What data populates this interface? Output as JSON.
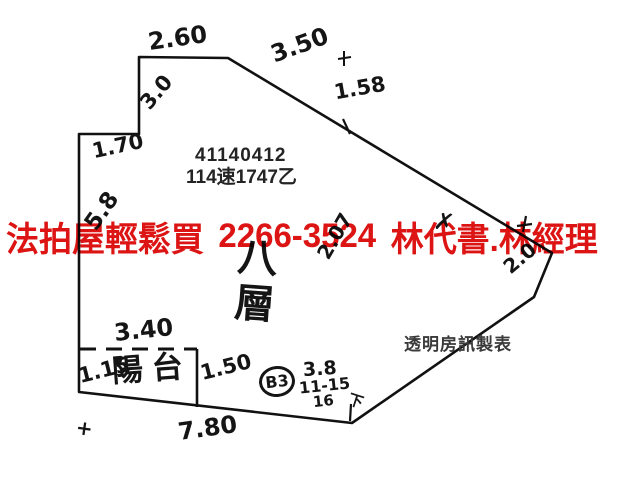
{
  "document": {
    "type_note": "hand-drawn foreclosure floor plan scan",
    "background_color": "#ffffff",
    "ink_color": "#151515"
  },
  "overlay_ad": {
    "parts": [
      "法拍屋輕鬆買",
      "2266-3524",
      "林代書.林經理"
    ],
    "full_text": "法拍屋輕鬆買 2266-3524 林代書.林經理",
    "color": "#dc1413"
  },
  "printed": {
    "case_number": "41140412",
    "registry_number": "114速1747乙",
    "maker_watermark": "透明房訊製表"
  },
  "floorplan": {
    "floor_label": "八層",
    "balcony_label": "陽台",
    "dimensions": {
      "top_edge": "2.60",
      "upper_diagonal": "3.50",
      "diagonal_segment": "1.58",
      "step_height": "3.0",
      "step_width": "1.70",
      "left_side": "5.8",
      "mid_scrawl": "2.07",
      "x_scribble": "✗",
      "right_corner": "2.0",
      "balcony_top": "3.40",
      "balcony_left": "1.15",
      "balcony_right": "1.50",
      "bottom_edge": "7.80"
    },
    "notes": {
      "circled_mark": "B3",
      "note_line1": "3.8",
      "note_line2": "11-15",
      "note_line3": "16",
      "corner_tick_label": "下",
      "plus_mark_top": "+",
      "plus_mark_bottom_left": "+"
    }
  }
}
